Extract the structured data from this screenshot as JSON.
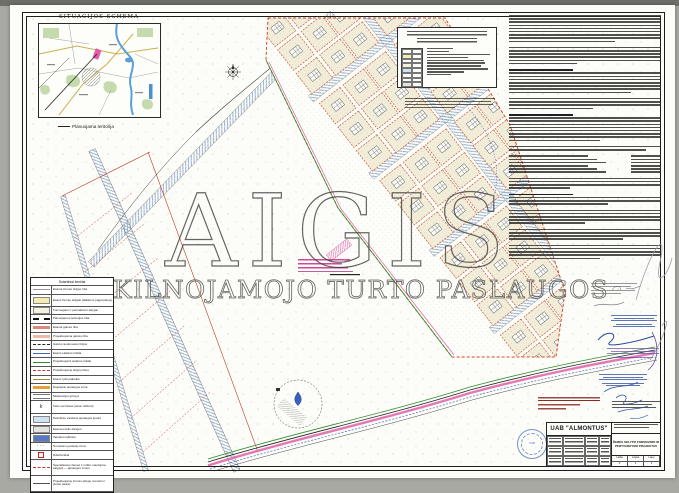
{
  "situation": {
    "title": "SITUACIJOS SCHEMA",
    "caption": "Planuojama teritorija"
  },
  "watermark": {
    "line1": "AIGIS",
    "line2": "NEKILNOJAMOJO TURTO PASLAUGOS"
  },
  "title_block": {
    "company": "UAB \"ALMONTUS\"",
    "project_title_1": "ŽEMĖS SKLYPO FORMAVIMO IR",
    "project_title_2": "PERTVARKYMO PROJEKTAS",
    "cols": [
      "Laida",
      "Lapas",
      "Lapų"
    ],
    "vals": [
      "0",
      "1",
      "1"
    ],
    "seal_text": "UAB"
  },
  "colors": {
    "parcel_fill": "#f2edd8",
    "parcel_border": "#c85a35",
    "road_hatch": "#8aa6c8",
    "green_line": "#2f8f2f",
    "magenta_line": "#e060a8",
    "red_line": "#c0392b",
    "blue_ink": "#2a4a9a",
    "purple_ink": "#6a4aa0",
    "seal_blue": "#3b5fb3",
    "watermark_stroke": "#3a3a38"
  },
  "top_legend": {
    "item_widths": [
      40,
      34,
      95,
      62,
      86,
      88,
      82,
      92,
      56,
      36
    ]
  },
  "right_column": {
    "blocks": [
      {
        "n": 9,
        "l": 70
      },
      {
        "n": 6,
        "l": 45
      },
      {
        "h": true,
        "n": 7,
        "l": 80
      },
      {
        "n": 4,
        "l": 55
      },
      {
        "h": true,
        "n": 8,
        "l": 60
      },
      {
        "n": 2,
        "l": 90
      },
      {
        "kv": 6
      },
      {
        "n": 4,
        "l": 40
      },
      {
        "h": true,
        "n": 3,
        "l": 65
      },
      {
        "n": 5,
        "l": 50
      },
      {
        "n": 4,
        "l": 75
      },
      {
        "n": 5,
        "l": 60
      }
    ]
  },
  "legend_table": {
    "rows": [
      {
        "s": "hdr",
        "t": "Sutartiniai ženklai"
      },
      {
        "s": "l",
        "c": "#999999",
        "t": "Esama žemės sklypo riba"
      },
      {
        "s": "f",
        "c": "#f3eeb0",
        "t": "Esami žemės sklypai (išlaikomi pagal planą)",
        "n": 2
      },
      {
        "s": "f",
        "c": "#f6f2e0",
        "t": "Formuojami ir pertvarkomi sklypai"
      },
      {
        "s": "db",
        "c": "#111111",
        "t": "Planuojamos teritorijos riba"
      },
      {
        "s": "th",
        "c": "#e08878",
        "t": "Esama gatvės riba"
      },
      {
        "s": "th",
        "c": "#f2b6a6",
        "t": "Projektuojama gatvės riba"
      },
      {
        "s": "dd",
        "c": "#222222",
        "t": "Gatvių raudonosios linijos"
      },
      {
        "s": "l",
        "c": "#4466bb",
        "t": "Esami elektros tinklai"
      },
      {
        "s": "l",
        "c": "#2f8f2f",
        "t": "Projektuojami elektros tinklai"
      },
      {
        "s": "d",
        "c": "#cc3333",
        "t": "Projektuojamų sklypų ribos"
      },
      {
        "s": "l",
        "c": "#9a8a30",
        "t": "Esami ryšių kabeliai"
      },
      {
        "s": "th",
        "c": "#e8a030",
        "t": "Dujotiekio apsaugos zona"
      },
      {
        "s": "dbl",
        "c": "#777777",
        "t": "Melioracijos griovys"
      },
      {
        "s": "k",
        "c": "#222222",
        "t": "Kelio servitutas (teisė važiuoti)",
        "n": 2
      },
      {
        "s": "f",
        "c": "#cfe3f0",
        "t": "Paviršinio vandens apsaugos juosta",
        "n": 2
      },
      {
        "s": "f",
        "c": "#e3e3df",
        "t": "Esamos kelio dangos"
      },
      {
        "s": "f",
        "c": "#5577c8",
        "t": "Vandens telkiniai"
      },
      {
        "s": "dot",
        "c": "#555555",
        "t": "Numatomų pastatų zona"
      },
      {
        "s": "sq",
        "c": "#cc2222",
        "t": "Riboženkliai"
      },
      {
        "s": "d",
        "c": "#cc3333",
        "t": "Specialiosios žemės ir miško naudojimo sąlygos — apsaugos zonos",
        "n": 3
      },
      {
        "s": "l",
        "c": "#555555",
        "t": "Projektuojamų žemės sklypų numeris ir plotas (arais)",
        "n": 3
      }
    ]
  }
}
